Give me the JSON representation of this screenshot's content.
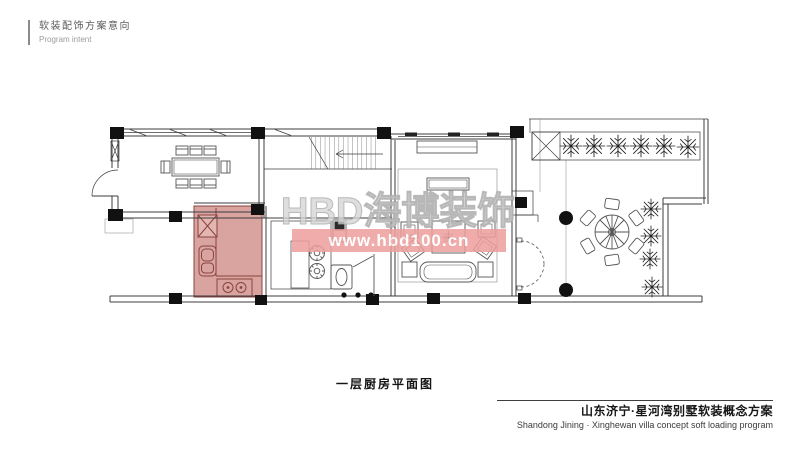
{
  "header": {
    "title_cn": "软装配饰方案意向",
    "title_en": "Program intent"
  },
  "watermark": {
    "brand": "HBD海博装饰",
    "url": "www.hbd100.cn"
  },
  "plan": {
    "caption": "一层厨房平面图",
    "highlighted_room": "kitchen",
    "rooms": [
      "dining-room",
      "upper-staircase",
      "kitchen",
      "inner-staircase",
      "bathroom",
      "living-room",
      "entrance",
      "courtyard"
    ]
  },
  "footer": {
    "title_cn": "山东济宁·星河湾别墅软装概念方案",
    "title_en": "Shandong Jining · Xinghewan villa concept soft loading program"
  },
  "colors": {
    "highlight_fill": "#d9a49f",
    "highlight_light": "#e3b6b1",
    "highlight_stroke": "#8a443f",
    "watermark_band": "#ee9e9c",
    "watermark_url_text": "#ffffff",
    "watermark_brand": "#c6c6c6",
    "line": "#3c3c3c",
    "furniture": "#555555",
    "column": "#111111"
  }
}
